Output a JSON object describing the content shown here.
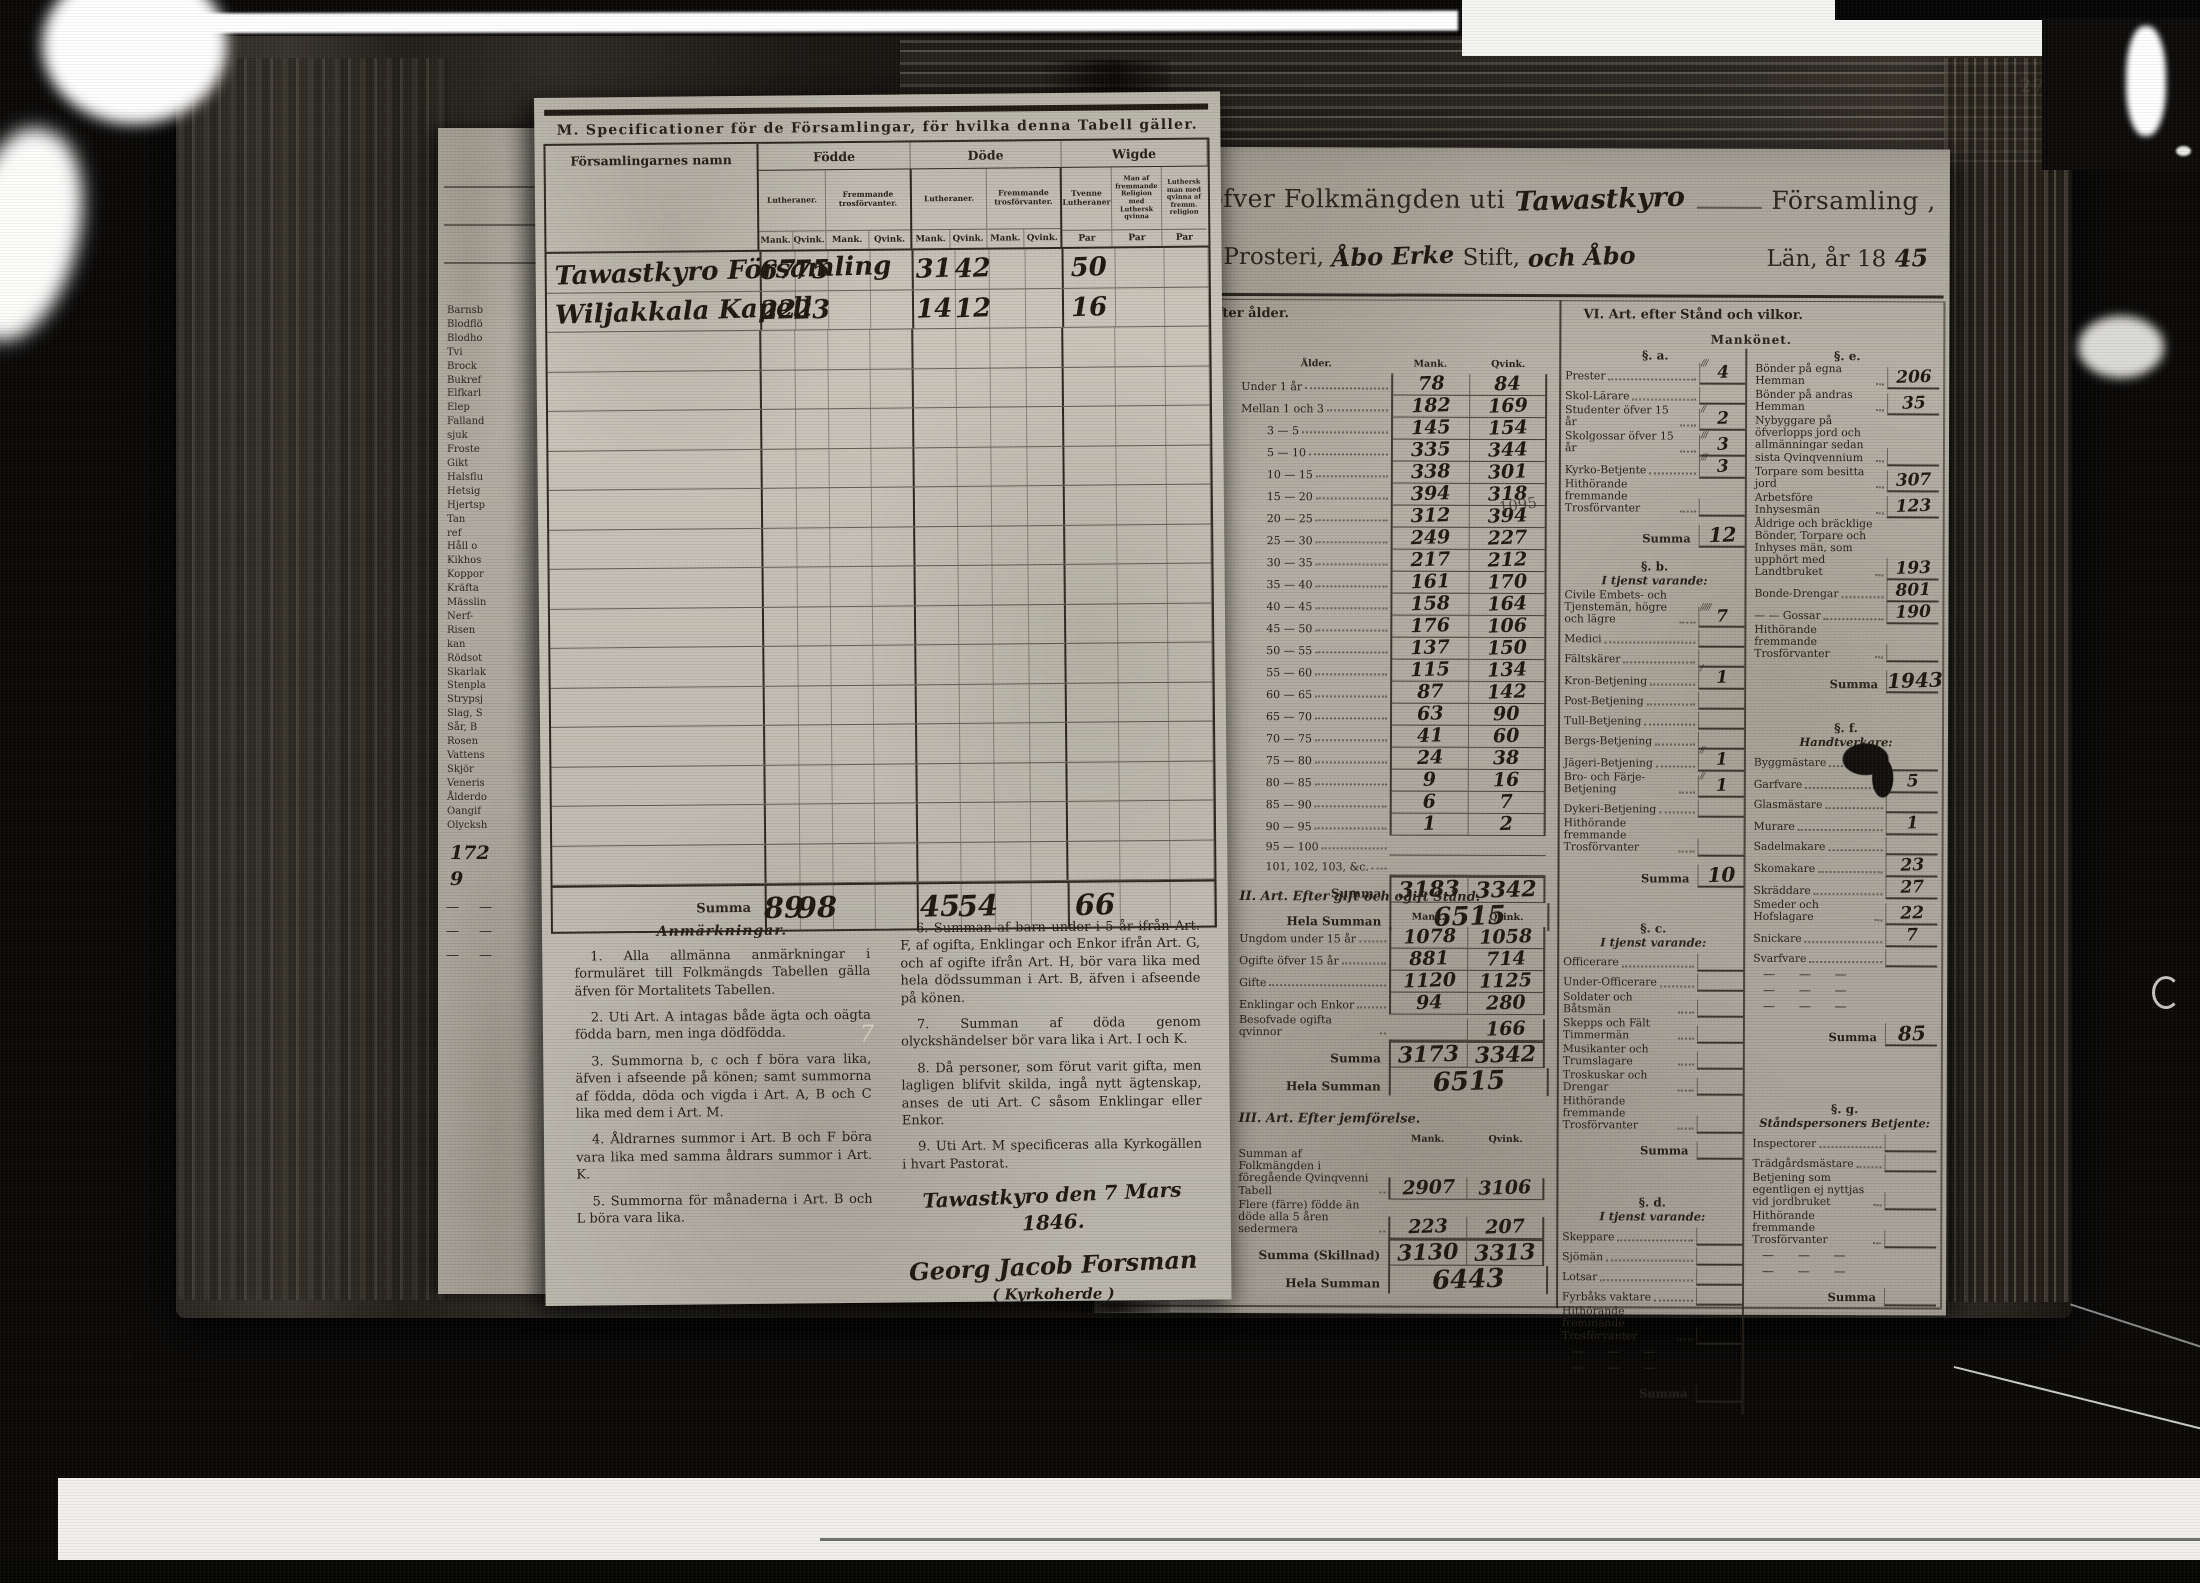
{
  "photo": {
    "page_number_top": "278",
    "page_number_inner": "272",
    "stray_mark": "7",
    "margin_pencil_note": "1095"
  },
  "under_page": {
    "death_cause_fragments": [
      "Barnsb",
      "Blodflö",
      "Blodho",
      "Tvi",
      "Brock",
      "Bukref",
      "Elfkarl",
      "Elep",
      "Falland",
      "sjuk",
      "Froste",
      "Gikt",
      "Halsflu",
      "Hetsig",
      "Hjertsp",
      "Tan",
      "ref",
      "Håll o",
      "Kikhos",
      "Koppor",
      "Kräfta",
      "Mässlin",
      "Nerf-",
      "Risen",
      "kan",
      "Rödsot",
      "Skarlak",
      "Stenpla",
      "Strypsj",
      "Slag, S",
      "Sår, B",
      "Rosen",
      "Vattens",
      "Skjör",
      "Veneris",
      "Ålderdo",
      "Oangif",
      "Olycksh"
    ],
    "notes": [
      "172",
      "9"
    ]
  },
  "form_page": {
    "title": "M. Specificationer för de Församlingar, för hvilka denna Tabell gäller.",
    "head": {
      "namn": "Församlingarnes namn",
      "fodde": "Födde",
      "dode": "Döde",
      "wigde": "Wigde",
      "lutheraner": "Lutheraner.",
      "fremmande": "Fremmande trosförvanter.",
      "mank": "Mank.",
      "qvink": "Qvink.",
      "par": "Par",
      "wigde_col1": "Tvenne Lutheraner",
      "wigde_col2": "Man af fremmande Religion med Luthersk qvinna",
      "wigde_col3": "Luthersk man med qvinna af fremm. religion"
    },
    "rows": [
      {
        "namn": "Tawastkyro Församling",
        "fodde_mank": "67",
        "fodde_qvink": "75",
        "dode_mank": "31",
        "dode_qvink": "42",
        "wigde_par": "50"
      },
      {
        "namn": "Wiljakkala Kapell",
        "fodde_mank": "22",
        "fodde_qvink": "23",
        "dode_mank": "14",
        "dode_qvink": "12",
        "wigde_par": "16"
      }
    ],
    "empty_rows": 14,
    "summa_label": "Summa",
    "summa": {
      "fodde_mank": "89",
      "fodde_qvink": "98",
      "dode_mank": "45",
      "dode_qvink": "54",
      "wigde_par": "66"
    },
    "anmarkningar": {
      "heading": "Anmärkningar.",
      "column1": [
        "1. Alla allmänna anmärkningar i formuläret till Folkmängds Tabellen gälla äfven för Mortalitets Tabellen.",
        "2. Uti Art. A intagas både ägta och oägta födda barn, men inga dödfödda.",
        "3. Summorna b, c och f böra vara lika, äfven i afseende på könen; samt summorna af födda, döda och vigda i Art. A, B och C lika med dem i Art. M.",
        "4. Åldrarnes summor i Art. B och F böra vara lika med samma åldrars summor i Art. K.",
        "5. Summorna för månaderna i Art. B och L böra vara lika."
      ],
      "column2": [
        "6. Summan af barn under i 5 år ifrån Art. F, af ogifta, Enklingar och Enkor ifrån Art. G, och af ogifte ifrån Art. H, bör vara lika med hela dödssumman i Art. B, äfven i afseende på könen.",
        "7. Summan af döda genom olyckshändelser bör vara lika i Art. I och K.",
        "8. Då personer, som förut varit gifta, men lagligen blifvit skilda, ingå nytt ägtenskap, anses de uti Art. C såsom Enklingar eller Enkor.",
        "9. Uti Art. M specificeras alla Kyrkogällen i hvart Pastorat."
      ]
    },
    "signature": {
      "place_date": "Tawastkyro den 7 Mars 1846.",
      "name": "Georg Jacob Forsman",
      "title": "Kyrkoherde"
    }
  },
  "table_page": {
    "title": {
      "part1": "Tabell öfver Folkmängden uti",
      "parish_hand": "Tawastkyro",
      "part2": "Församling ,",
      "part3": "i",
      "prosteri_hand": "Tyrvis",
      "part4": "Prosteri,",
      "stift_hand": "Åbo Erke",
      "part5": "Stift,",
      "lan_hand": "och Åbo",
      "part6": "Län, år 18",
      "year_hand": "45"
    },
    "sections": {
      "age_header": "I. Art. efter ålder.",
      "stand_header": "VI. Art. efter Stånd och vilkor.",
      "mankonet": "Mankönet."
    },
    "labels": {
      "alder": "Ålder.",
      "mank": "Mank.",
      "qvink": "Qvink.",
      "summa": "Summa",
      "hela_summan": "Hela Summan",
      "summa_skillnad": "Summa (Skillnad)"
    },
    "age_table": {
      "rows": [
        [
          "Under 1 år",
          "78",
          "84"
        ],
        [
          "Mellan 1 och 3",
          "182",
          "169"
        ],
        [
          "3 — 5",
          "145",
          "154"
        ],
        [
          "5 — 10",
          "335",
          "344"
        ],
        [
          "10 — 15",
          "338",
          "301"
        ],
        [
          "15 — 20",
          "394",
          "318"
        ],
        [
          "20 — 25",
          "312",
          "394"
        ],
        [
          "25 — 30",
          "249",
          "227"
        ],
        [
          "30 — 35",
          "217",
          "212"
        ],
        [
          "35 — 40",
          "161",
          "170"
        ],
        [
          "40 — 45",
          "158",
          "164"
        ],
        [
          "45 — 50",
          "176",
          "106"
        ],
        [
          "50 — 55",
          "137",
          "150"
        ],
        [
          "55 — 60",
          "115",
          "134"
        ],
        [
          "60 — 65",
          "87",
          "142"
        ],
        [
          "65 — 70",
          "63",
          "90"
        ],
        [
          "70 — 75",
          "41",
          "60"
        ],
        [
          "75 — 80",
          "24",
          "38"
        ],
        [
          "80 — 85",
          "9",
          "16"
        ],
        [
          "85 — 90",
          "6",
          "7"
        ],
        [
          "90 — 95",
          "1",
          "2"
        ],
        [
          "95 — 100",
          "",
          ""
        ],
        [
          "101, 102, 103, &c.",
          "",
          ""
        ]
      ],
      "summa": [
        "3183",
        "3342"
      ],
      "hela": "6515"
    },
    "gift_table": {
      "header": "II. Art. Efter gift och ogift Stånd.",
      "rows": [
        [
          "Ungdom under 15 år",
          "1078",
          "1058"
        ],
        [
          "Ogifte öfver 15 år",
          "881",
          "714"
        ],
        [
          "Gifte",
          "1120",
          "1125"
        ],
        [
          "Enklingar och Enkor",
          "94",
          "280"
        ],
        [
          "Besofvade ogifta qvinnor",
          "",
          "166"
        ]
      ],
      "summa": [
        "3173",
        "3342"
      ],
      "hela": "6515"
    },
    "jemforelse_table": {
      "header": "III. Art. Efter jemförelse.",
      "rows": [
        [
          "Summan af Folkmängden i föregående Qvinqvenni Tabell",
          "2907",
          "3106"
        ],
        [
          "Flere (färre) födde än döde alla 5 åren sedermera",
          "223",
          "207"
        ]
      ],
      "summa": [
        "3130",
        "3313"
      ],
      "hela": "6443"
    },
    "stand_groups_left": [
      {
        "heading": "§. a.",
        "sub": "",
        "items": [
          [
            "Prester",
            "4",
            "///"
          ],
          [
            "Skol-Lärare",
            "",
            ""
          ],
          [
            "Studenter öfver 15 år",
            "2",
            "//"
          ],
          [
            "Skolgossar öfver 15 år",
            "3",
            "///"
          ],
          [
            "Kyrko-Betjente",
            "3",
            "///"
          ],
          [
            "Hithörande fremmande Trosförvanter",
            "",
            ""
          ]
        ],
        "summa": "12",
        "dashes": 0
      },
      {
        "heading": "§. b.",
        "sub": "I tjenst varande:",
        "items": [
          [
            "Civile Embets- och Tjenstemän, högre och lägre",
            "7",
            "/////"
          ],
          [
            "Medici",
            "",
            ""
          ],
          [
            "Fältskärer",
            "",
            ""
          ],
          [
            "Kron-Betjening",
            "1",
            "/"
          ],
          [
            "Post-Betjening",
            "",
            ""
          ],
          [
            "Tull-Betjening",
            "",
            ""
          ],
          [
            "Bergs-Betjening",
            "",
            ""
          ],
          [
            "Jägeri-Betjening",
            "1",
            "//"
          ],
          [
            "Bro- och Färje-Betjening",
            "1",
            "//"
          ],
          [
            "Dykeri-Betjening",
            "",
            ""
          ],
          [
            "Hithörande fremmande Trosförvanter",
            "",
            ""
          ]
        ],
        "summa": "10",
        "dashes": 0
      },
      {
        "heading": "§. c.",
        "sub": "I tjenst varande:",
        "items": [
          [
            "Officerare",
            "",
            ""
          ],
          [
            "Under-Officerare",
            "",
            ""
          ],
          [
            "Soldater och Båtsmän",
            "",
            ""
          ],
          [
            "Skepps och Fält Timmermän",
            "",
            ""
          ],
          [
            "Musikanter och Trumslagare",
            "",
            ""
          ],
          [
            "Troskuskar och Drengar",
            "",
            ""
          ],
          [
            "Hithörande fremmande Trosförvanter",
            "",
            ""
          ]
        ],
        "summa": "",
        "dashes": 0
      },
      {
        "heading": "§. d.",
        "sub": "I tjenst varande:",
        "items": [
          [
            "Skeppare",
            "",
            ""
          ],
          [
            "Sjömän",
            "",
            ""
          ],
          [
            "Lotsar",
            "",
            ""
          ],
          [
            "Fyrbåks vaktare",
            "",
            ""
          ],
          [
            "Hithörande fremmande Trosförvanter",
            "",
            ""
          ]
        ],
        "summa": "",
        "dashes": 2
      }
    ],
    "stand_groups_right": [
      {
        "heading": "§. e.",
        "sub": "",
        "items": [
          [
            "Bönder på egna Hemman",
            "206",
            ""
          ],
          [
            "Bönder på andras Hemman",
            "35",
            ""
          ],
          [
            "Nybyggare på öfverlopps jord och allmänningar sedan sista Qvinqvennium",
            "",
            ""
          ],
          [
            "Torpare som besitta jord",
            "307",
            ""
          ],
          [
            "Arbetsföre Inhysesmän",
            "123",
            ""
          ],
          [
            "Åldrige och bräcklige Bönder, Torpare och Inhyses män, som upphört med Landtbruket",
            "193",
            ""
          ],
          [
            "Bonde-Drengar",
            "801",
            ""
          ],
          [
            "— — Gossar",
            "190",
            ""
          ],
          [
            "Hithörande fremmande Trosförvanter",
            "",
            ""
          ]
        ],
        "summa": "1943",
        "dashes": 0
      },
      {
        "heading": "§. f.",
        "sub": "Handtverkare:",
        "items": [
          [
            "Byggmästare",
            "",
            ""
          ],
          [
            "Garfvare",
            "5",
            ""
          ],
          [
            "Glasmästare",
            "",
            ""
          ],
          [
            "Murare",
            "1",
            ""
          ],
          [
            "Sadelmakare",
            "",
            ""
          ],
          [
            "Skomakare",
            "23",
            ""
          ],
          [
            "Skräddare",
            "27",
            ""
          ],
          [
            "Smeder och Hofslagare",
            "22",
            ""
          ],
          [
            "Snickare",
            "7",
            ""
          ],
          [
            "Svarfvare",
            "",
            ""
          ]
        ],
        "summa": "85",
        "dashes": 3
      },
      {
        "heading": "§. g.",
        "sub": "Ståndspersoners Betjente:",
        "items": [
          [
            "Inspectorer",
            "",
            ""
          ],
          [
            "Trädgårdsmästare",
            "",
            ""
          ],
          [
            "Betjening som egentligen ej nyttjas vid jordbruket",
            "",
            ""
          ],
          [
            "Hithörande fremmande Trosförvanter",
            "",
            ""
          ]
        ],
        "summa": "",
        "dashes": 2
      }
    ]
  }
}
